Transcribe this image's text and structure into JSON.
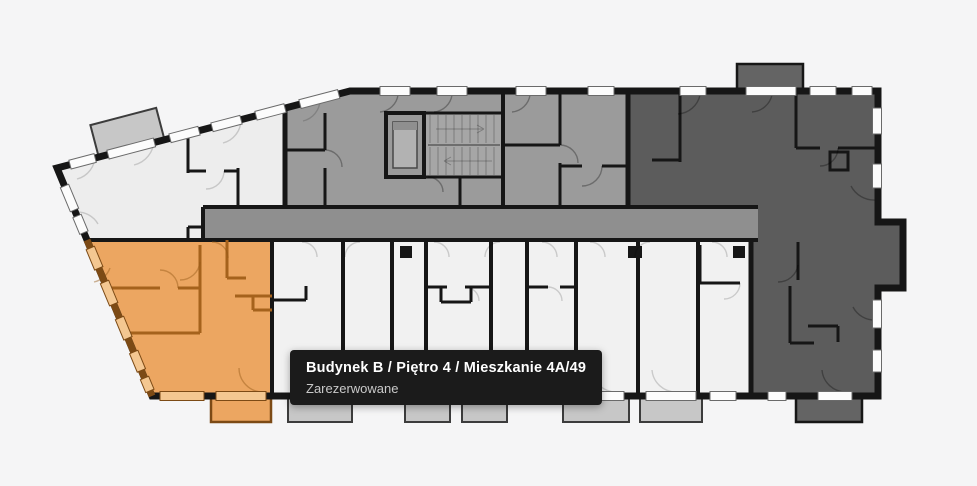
{
  "tooltip": {
    "title": "Budynek B / Piętro 4 / Mieszkanie 4A/49",
    "status": "Zarezerwowane"
  },
  "colors": {
    "background": "#f5f5f6",
    "wall": "#161616",
    "room_light": "#ededed",
    "room_bottom": "#f1f1f1",
    "room_medium": "#9b9b9b",
    "corridor": "#8f8f8f",
    "room_dark": "#5c5c5c",
    "balcony_light": "#c7c7c7",
    "balcony_dark": "#646464",
    "window": "#fcfcfc",
    "selected_fill": "#eca661",
    "selected_wall": "#a5621c",
    "selected_outer": "#7c4a15",
    "selected_window": "#f4c791",
    "tooltip_bg": "#1b1b1b",
    "tooltip_title": "#ffffff",
    "tooltip_status": "#c9c9c9"
  }
}
